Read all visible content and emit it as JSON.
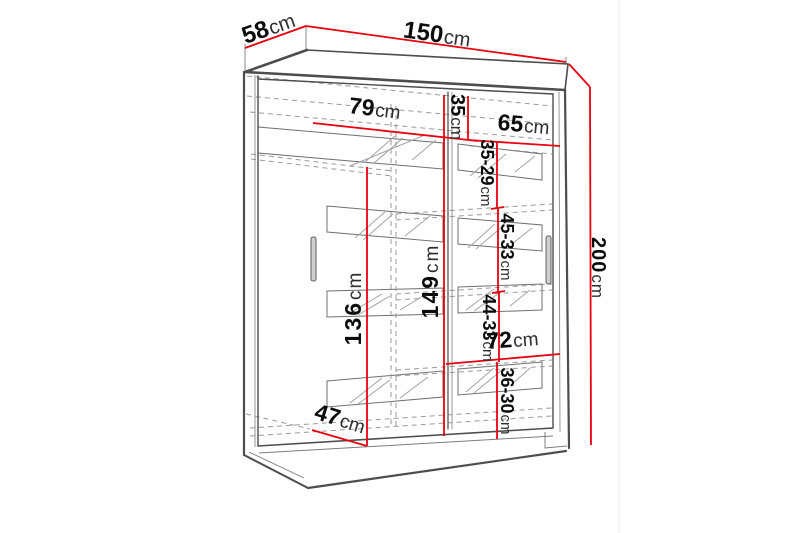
{
  "diagram": {
    "type": "wardrobe-dimension-drawing",
    "unit": "cm",
    "colors": {
      "dimension_line": "#e8000f",
      "outline": "#4d4d4d",
      "hidden_line": "#9a9a9a",
      "background": "#ffffff"
    },
    "dimensions": {
      "top_depth": {
        "num": "58",
        "unit": "cm"
      },
      "top_width": {
        "num": "150",
        "unit": "cm"
      },
      "height": {
        "num": "200",
        "unit": "cm"
      },
      "upper_shelf_left_width": {
        "num": "79",
        "unit": "cm"
      },
      "upper_gap": {
        "num": "35",
        "unit": "cm"
      },
      "upper_shelf_right_width": {
        "num": "65",
        "unit": "cm"
      },
      "shelf_gap_1": {
        "num": "35-29",
        "unit": "cm"
      },
      "shelf_gap_2": {
        "num": "45-33",
        "unit": "cm"
      },
      "hanging_section_height": {
        "num": "136",
        "unit": "cm"
      },
      "inner_right_height": {
        "num": "149",
        "unit": "cm"
      },
      "shelf_gap_3": {
        "num": "44-33",
        "unit": "cm"
      },
      "lower_shelf_width": {
        "num": "72",
        "unit": "cm"
      },
      "shelf_gap_4": {
        "num": "36-30",
        "unit": "cm"
      },
      "inner_depth": {
        "num": "47",
        "unit": "cm"
      }
    }
  }
}
